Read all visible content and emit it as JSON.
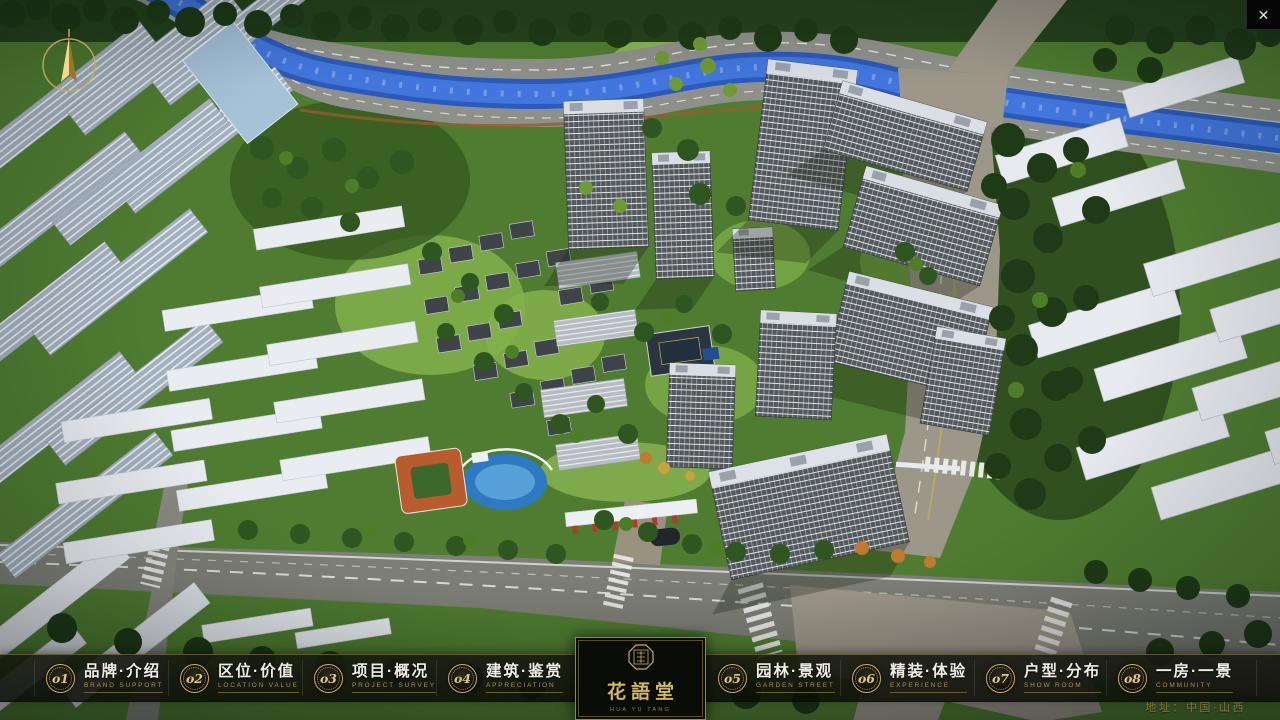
{
  "window": {
    "close_glyph": "✕"
  },
  "menu": {
    "items": [
      {
        "num": "o1",
        "zh": "品牌·介绍",
        "en": "BRAND SUPPORT"
      },
      {
        "num": "o2",
        "zh": "区位·价值",
        "en": "LOCATION VALUE"
      },
      {
        "num": "o3",
        "zh": "项目·概况",
        "en": "PROJECT SURVEY"
      },
      {
        "num": "o4",
        "zh": "建筑·鉴赏",
        "en": "APPRECIATION"
      },
      {
        "num": "o5",
        "zh": "园林·景观",
        "en": "GARDEN STREET"
      },
      {
        "num": "o6",
        "zh": "精装·体验",
        "en": "EXPERIENCE"
      },
      {
        "num": "o7",
        "zh": "户型·分布",
        "en": "SHOW ROOM"
      },
      {
        "num": "o8",
        "zh": "一房·一景",
        "en": "COMMUNITY"
      }
    ]
  },
  "logo": {
    "name": "花語堂",
    "subtext": "HUA YU TANG"
  },
  "footer": {
    "address": "地址：中国·山西"
  },
  "colors": {
    "accent_gold": "#c9ad62",
    "bar_background": "#14160e",
    "text_primary": "#efede5",
    "text_gold": "#ab9254",
    "panel_black": "#0a0c07",
    "river_blue": "#2b59bd",
    "tree_green": "#2f5520",
    "road_gray": "#7d7f76"
  }
}
